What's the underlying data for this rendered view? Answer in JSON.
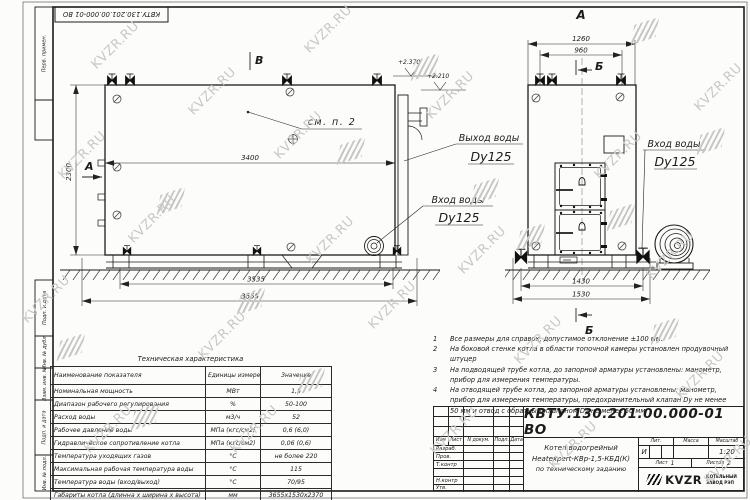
{
  "sheet": {
    "stamp_top": "КВТУ.130.201.00.000-01 ВО",
    "format_label": "Формат",
    "format_value": "А3",
    "margin_labels": [
      "Перв. примен.",
      "Подп. и дата",
      "Инв. № дубл.",
      "Взам. инв. №",
      "Подп. и дата",
      "Инв. № подл."
    ]
  },
  "watermark": {
    "text": "KVZR.RU",
    "color": "#c8c8c8"
  },
  "drawing": {
    "view_labels": {
      "v_top": "В",
      "a_side": "А",
      "a_view": "А",
      "b_top": "Б",
      "b_bottom": "Б"
    },
    "note_ref": "см. п. 2",
    "elevations": {
      "top": "+2.370",
      "lower": "+2.210"
    },
    "dims": {
      "inner_len": "3400",
      "height": "2300",
      "feet_span": "3535",
      "total_len": "3655",
      "front_w1": "1260",
      "front_w2": "960",
      "front_feet": "1430",
      "front_total": "1530"
    },
    "callouts": {
      "outlet": {
        "line1": "Выход воды",
        "line2": "Dy125"
      },
      "inlet_side": {
        "line1": "Вход воды",
        "line2": "Dy125"
      },
      "inlet_front": {
        "line1": "Вход воды",
        "line2": "Dy125"
      }
    }
  },
  "notes": [
    {
      "num": "1",
      "text": "Все размеры для справок, допустимое отклонение ±100 мм."
    },
    {
      "num": "2",
      "text": "На боковой стенке котла в области топочной камеры установлен продувочный штуцер"
    },
    {
      "num": "3",
      "text": "На подводящей трубе котла, до запорной арматуры установлены: манометр, прибор для измерения температуры."
    },
    {
      "num": "4",
      "text": "На отводящей трубе котла, до запорной арматуры установлены: манометр, прибор для измерения температуры, предохранительный клапан Dy не менее 50 мм и отвод с обратным клапаном Dy не менее 50 мм."
    }
  ],
  "tech_table": {
    "title": "Техническая характеристика",
    "headers": [
      "Наименование показателя",
      "Единицы измерения",
      "Значение"
    ],
    "rows": [
      [
        "Номинальная мощность",
        "МВт",
        "1,5"
      ],
      [
        "Диапазон рабочего регулирования",
        "%",
        "50-100"
      ],
      [
        "Расход воды",
        "м3/ч",
        "52"
      ],
      [
        "Рабочее давление воды",
        "МПа (кгс/см2)",
        "0,6 (6,0)"
      ],
      [
        "Гидравлическое сопротивление котла",
        "МПа (кгс/см2)",
        "0,06 (0,6)"
      ],
      [
        "Температура уходящих газов",
        "°С",
        "не более 220"
      ],
      [
        "Максимальная рабочая температура воды",
        "°С",
        "115"
      ],
      [
        "Температура воды (вход/выход)",
        "°С",
        "70/95"
      ],
      [
        "Габариты котла (длинна х ширина х высота)",
        "мм",
        "3655х1530х2370"
      ]
    ]
  },
  "title_block": {
    "doc_number": "КВТУ.130.201.00.000-01 ВО",
    "rev_headers": [
      "Изм",
      "Лист",
      "N докум.",
      "Подп.",
      "Дата"
    ],
    "row_labels": [
      "Разраб.",
      "Пров.",
      "Т.контр",
      "",
      "Н.контр",
      "Утв."
    ],
    "title_lines": [
      "Котел водогрейный",
      "Heatexpert-КВр-1,5-КБД(К)",
      "по техническому заданию"
    ],
    "lit_header": "Лит.",
    "lit_value": "И",
    "mass_header": "Масса",
    "scale_header": "Масштаб",
    "scale_value": "1:20",
    "sheet_label": "Лист",
    "sheet_value": "1",
    "sheets_label": "Листов",
    "sheets_value": "2",
    "logo_text": "KVZR",
    "company_line1": "КОТЕЛЬНЫЙ",
    "company_line2": "ЗАВОД РЭП"
  }
}
